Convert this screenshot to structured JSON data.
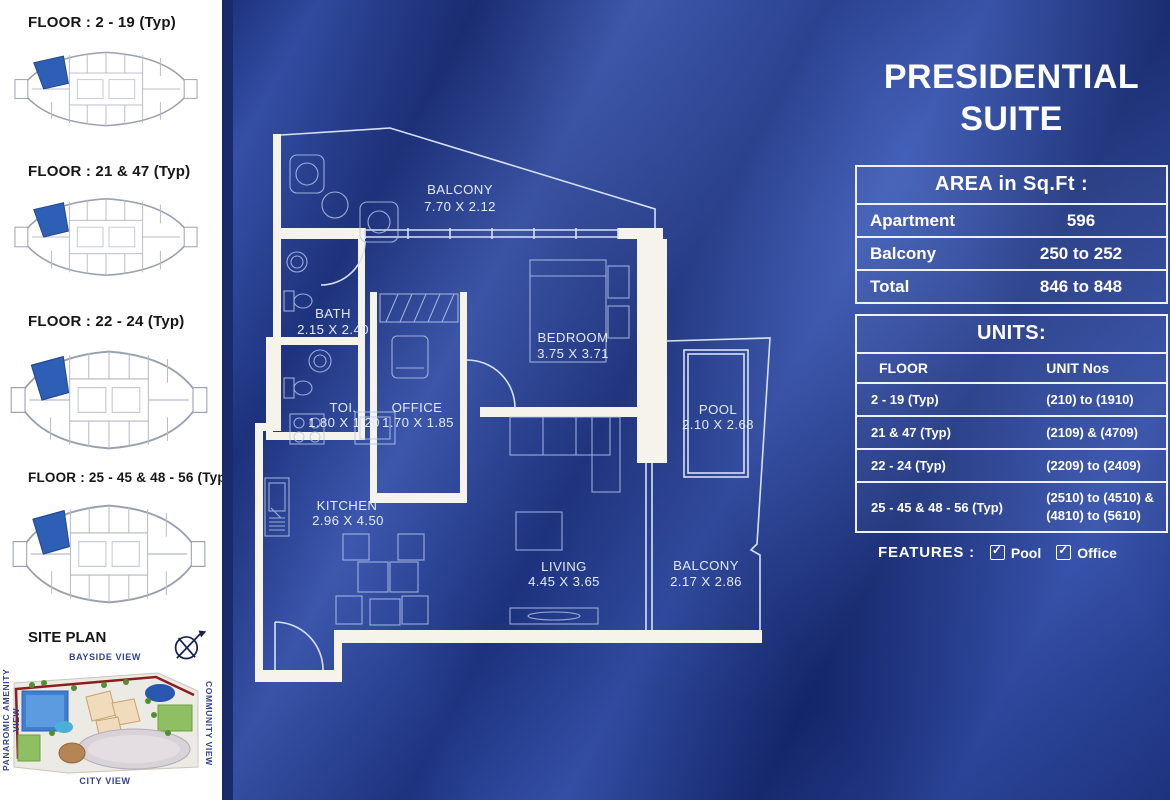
{
  "title": {
    "line1": "PRESIDENTIAL",
    "line2": "SUITE"
  },
  "sidebar": {
    "floor_plans": [
      {
        "label": "FLOOR : 2 - 19 (Typ)"
      },
      {
        "label": "FLOOR : 21 & 47 (Typ)"
      },
      {
        "label": "FLOOR : 22  - 24 (Typ)"
      },
      {
        "label": "FLOOR : 25 - 45 & 48 - 56 (Typ)"
      }
    ],
    "site_plan": {
      "title": "SITE PLAN",
      "view_top": "BAYSIDE VIEW",
      "view_bottom": "CITY VIEW",
      "view_left": "PANAROMIC AMENITY VIEW",
      "view_right": "COMMUNITY VIEW"
    }
  },
  "area_table": {
    "header": "AREA in Sq.Ft :",
    "rows": [
      {
        "label": "Apartment",
        "value": "596"
      },
      {
        "label": "Balcony",
        "value": "250 to 252"
      },
      {
        "label": "Total",
        "value": "846 to 848"
      }
    ]
  },
  "units_table": {
    "header": "UNITS:",
    "col_floor": "FLOOR",
    "col_units": "UNIT Nos",
    "rows": [
      {
        "floor": "2 - 19 (Typ)",
        "units": "(210) to (1910)"
      },
      {
        "floor": "21 & 47 (Typ)",
        "units": "(2109) & (4709)"
      },
      {
        "floor": "22 - 24 (Typ)",
        "units": "(2209) to (2409)"
      },
      {
        "floor": "25 - 45 & 48 - 56 (Typ)",
        "units": "(2510) to (4510) & (4810) to (5610)"
      }
    ]
  },
  "features": {
    "label": "FEATURES :",
    "items": [
      {
        "name": "Pool",
        "checked": true
      },
      {
        "name": "Office",
        "checked": true
      }
    ]
  },
  "floor_plan": {
    "rooms": [
      {
        "name": "BALCONY",
        "dims": "7.70 X 2.12"
      },
      {
        "name": "BATH",
        "dims": "2.15 X 2.40"
      },
      {
        "name": "BEDROOM",
        "dims": "3.75 X 3.71"
      },
      {
        "name": "TOI.",
        "dims": "1.80 X 1.20"
      },
      {
        "name": "OFFICE",
        "dims": "1.70 X 1.85"
      },
      {
        "name": "POOL",
        "dims": "2.10 X 2.68"
      },
      {
        "name": "KITCHEN",
        "dims": "2.96 X 4.50"
      },
      {
        "name": "LIVING",
        "dims": "4.45 X 3.65"
      },
      {
        "name": "BALCONY",
        "dims": "2.17 X 2.86"
      }
    ]
  },
  "colors": {
    "background_blue": "#1f3a96",
    "wall_cream": "#f6f3ea",
    "plan_line": "#d7e0f6",
    "highlight_unit_blue": "#2e5fb7",
    "table_border": "#edf1fa",
    "navy_strip": "#1b2a6b"
  }
}
